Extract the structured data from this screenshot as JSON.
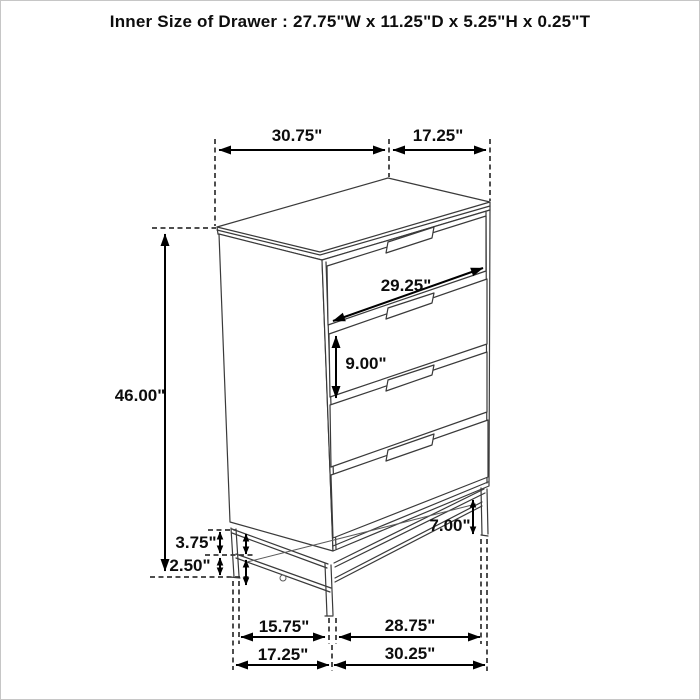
{
  "title": "Inner Size of Drawer : 27.75\"W x 11.25\"D x 5.25\"H x 0.25\"T",
  "figure": {
    "type": "furniture-dimension-diagram",
    "item": "4-drawer chest with metal base",
    "drawer_count": 4
  },
  "dimensions": {
    "top_width": "30.75\"",
    "top_depth": "17.25\"",
    "overall_height": "46.00\"",
    "drawer_front_width": "29.25\"",
    "drawer_front_height": "9.00\"",
    "base_height_right": "7.00\"",
    "base_rail_gap": "3.75\"",
    "base_floor_gap": "2.50\"",
    "leg_span_side_inner": "15.75\"",
    "leg_span_front_inner": "28.75\"",
    "leg_span_side_outer": "17.25\"",
    "leg_span_front_outer": "30.25\""
  },
  "colors": {
    "ink": "#000000",
    "furniture_line": "#3a3a3a",
    "background": "#ffffff",
    "border": "#c6c6c6"
  }
}
